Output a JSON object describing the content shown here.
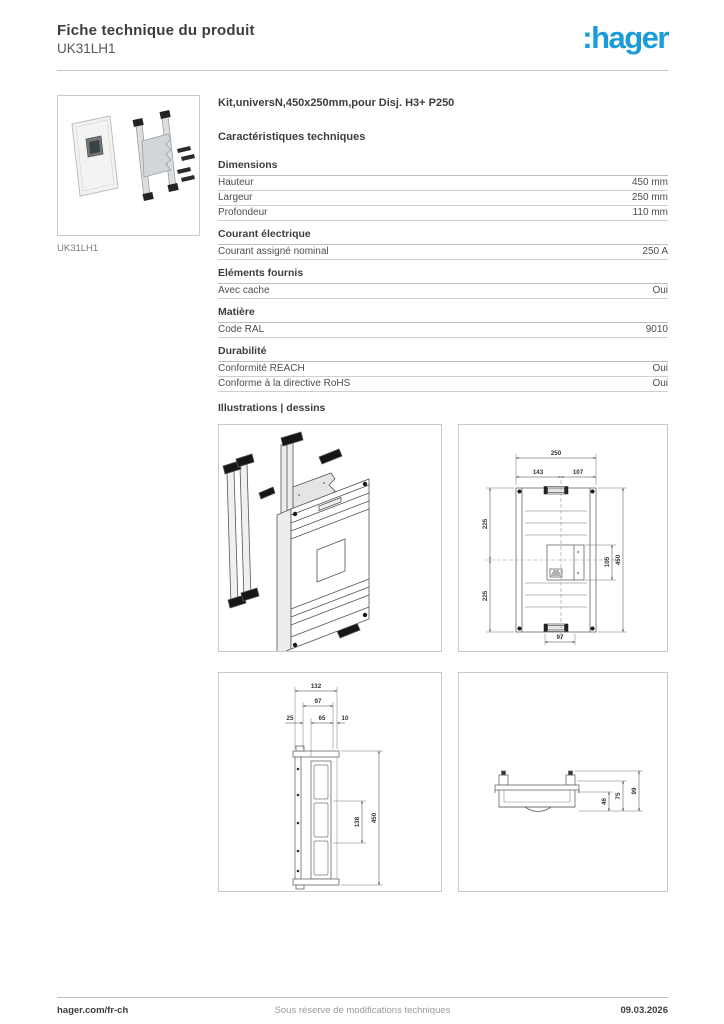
{
  "header": {
    "title": "Fiche technique du produit",
    "product_ref": "UK31LH1",
    "logo_text": ":hager",
    "brand_color": "#1b9cd8"
  },
  "product": {
    "description": "Kit,universN,450x250mm,pour Disj. H3+ P250",
    "image_caption": "UK31LH1"
  },
  "characteristics": {
    "heading": "Caractéristiques techniques",
    "sections": [
      {
        "title": "Dimensions",
        "rows": [
          {
            "label": "Hauteur",
            "value": "450 mm"
          },
          {
            "label": "Largeur",
            "value": "250 mm"
          },
          {
            "label": "Profondeur",
            "value": "110 mm"
          }
        ]
      },
      {
        "title": "Courant électrique",
        "rows": [
          {
            "label": "Courant assigné nominal",
            "value": "250 A"
          }
        ]
      },
      {
        "title": "Eléments fournis",
        "rows": [
          {
            "label": "Avec cache",
            "value": "Oui"
          }
        ]
      },
      {
        "title": "Matière",
        "rows": [
          {
            "label": "Code RAL",
            "value": "9010"
          }
        ]
      },
      {
        "title": "Durabilité",
        "rows": [
          {
            "label": "Conformité REACH",
            "value": "Oui"
          },
          {
            "label": "Conforme à la directive RoHS",
            "value": "Oui"
          }
        ]
      }
    ]
  },
  "illustrations": {
    "heading": "Illustrations | dessins",
    "front_view": {
      "w_total": "250",
      "w_left": "143",
      "w_right": "107",
      "h_top": "225",
      "h_bottom": "225",
      "h_inner": "105",
      "h_total": "450",
      "w_bottom": "97"
    },
    "side_view": {
      "d_total": "132",
      "d_sub": "97",
      "s_left": "25",
      "s_mid": "65",
      "s_right": "10",
      "h_inner": "138",
      "h_total": "450"
    },
    "profile_view": {
      "h_inner": "46",
      "h_mid": "75",
      "h_total": "99"
    }
  },
  "footer": {
    "website": "hager.com/fr-ch",
    "note": "Sous réserve de modifications techniques",
    "date": "09.03.2026"
  }
}
